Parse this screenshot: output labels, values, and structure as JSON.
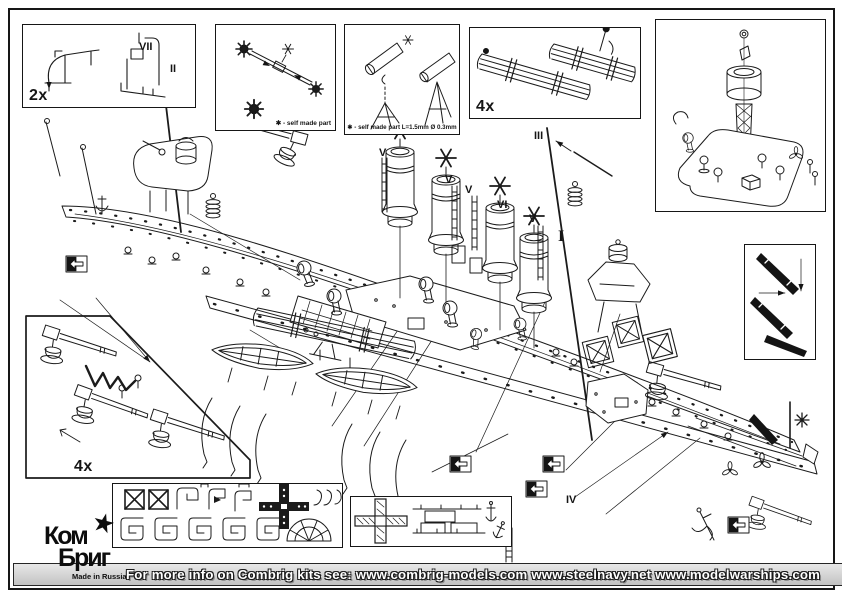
{
  "footer": {
    "info_text": "For more info on Combrig kits see: www.combrig-models.com www.steelnavy.net  www.modelwarships.com",
    "kit_number": "70674"
  },
  "logo": {
    "line1": "Ком",
    "line2": "Бриг",
    "tagline": "Made in Russia",
    "star": "★"
  },
  "insets": {
    "davits": {
      "quantity": "2x"
    },
    "yards": {
      "caption": "✱ - self made part"
    },
    "searchlights": {
      "caption": "✱ - self made part L=1.5mm  Ø 0.3mm"
    },
    "oars": {
      "quantity": "4x"
    },
    "guns": {
      "quantity": "4x"
    }
  },
  "part_labels": [
    "VII",
    "II",
    "III",
    "I",
    "IV",
    "VI",
    "V",
    "V",
    "V",
    "V"
  ]
}
